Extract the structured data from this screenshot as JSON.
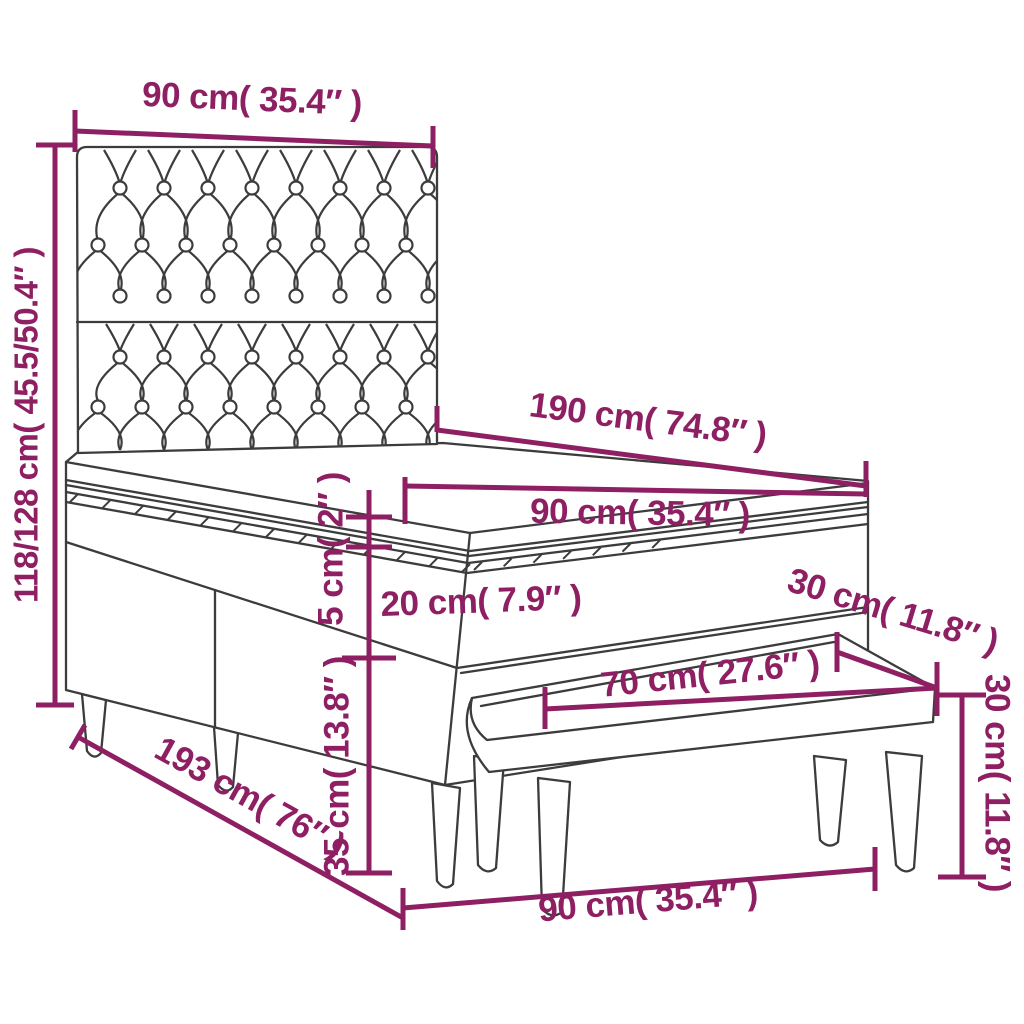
{
  "page": {
    "background": "#ffffff"
  },
  "palette": {
    "dimension_color": "#8e1f63",
    "outline_color": "#3c3c3c"
  },
  "diagram": {
    "type": "furniture-dimension-diagram",
    "subject": "box spring bed with tufted headboard, mattress topper and bench",
    "dimensions": {
      "headboard_width": "90 cm( 35.4″ )",
      "overall_height": "118/128 cm( 45.5/50.4″ )",
      "bed_length": "190 cm( 74.8″ )",
      "mattress_width": "90 cm( 35.4″ )",
      "topper_thickness": "5 cm( 2″ )",
      "mattress_thickness": "20 cm( 7.9″ )",
      "bench_depth": "30 cm( 11.8″ )",
      "bench_length": "70 cm( 27.6″ )",
      "base_height": "35 cm( 13.8″ )",
      "bench_height": "30 cm( 11.8″ )",
      "overall_length": "193 cm( 76″ )",
      "bench_span_width": "90 cm( 35.4″ )"
    }
  }
}
